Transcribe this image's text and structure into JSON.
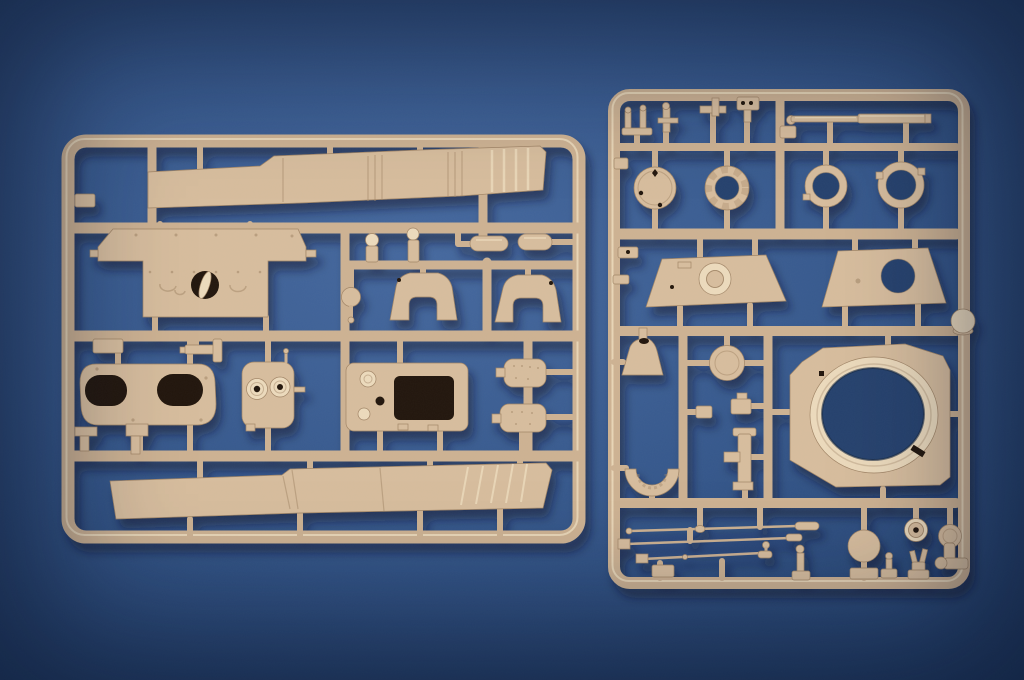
{
  "scene": {
    "type": "product-photograph",
    "description": "Two tan injection-molded plastic model kit sprues (parts frames) for an armored vehicle kit, laid on a blue studio backdrop",
    "objects": [
      "left parts sprue with hull plates",
      "right parts sprue with turret ring, hatches and antenna rods"
    ]
  },
  "colors": {
    "bg_center": "#45689e",
    "bg_mid": "#35578b",
    "bg_edge": "#203d68",
    "bg_through": "#26436e",
    "plastic": "#d7bd9d",
    "plastic_light": "#ecdabc",
    "plastic_dark": "#a18566",
    "runner": "#cdb292",
    "hole_dark": "#241708"
  },
  "left_sprue": {
    "id": "sprue-a",
    "parts": [
      "upper-hull-plate",
      "engine-deck-plate-round-hatch",
      "knob-pin-a",
      "knob-pin-b",
      "stowage-capsule-a",
      "stowage-capsule-b",
      "ball-pin",
      "mantlet-arch-a",
      "mantlet-arch-b",
      "hatch-frame-twin-ovals",
      "periscope-housing-twin-rings",
      "access-plate-rect-opening",
      "fuel-tank-a",
      "fuel-tank-b",
      "mg-mount-bracket",
      "small-plate",
      "tow-clevis-a",
      "tow-clevis-b",
      "lower-hull-plate"
    ]
  },
  "right_sprue": {
    "id": "sprue-b",
    "parts": [
      "lifting-hook-a",
      "lifting-hook-b",
      "l-bracket",
      "clamp-block",
      "gun-barrel",
      "hatch-disc",
      "splined-ring",
      "hatch-ring-a",
      "hatch-ring-b",
      "turret-roof-plate",
      "hatch-plate-round-opening",
      "dome-knob",
      "ventilator-cone",
      "wheel-disc",
      "turret-ring-base",
      "horseshoe-guard",
      "tee-bracket",
      "step-block",
      "antenna-rod-a",
      "antenna-rod-b",
      "antenna-rod-c",
      "pin-figure-a",
      "pin-figure-b",
      "road-wheel",
      "idler-disc",
      "hatch-disc-small",
      "elbow-pipe"
    ]
  }
}
